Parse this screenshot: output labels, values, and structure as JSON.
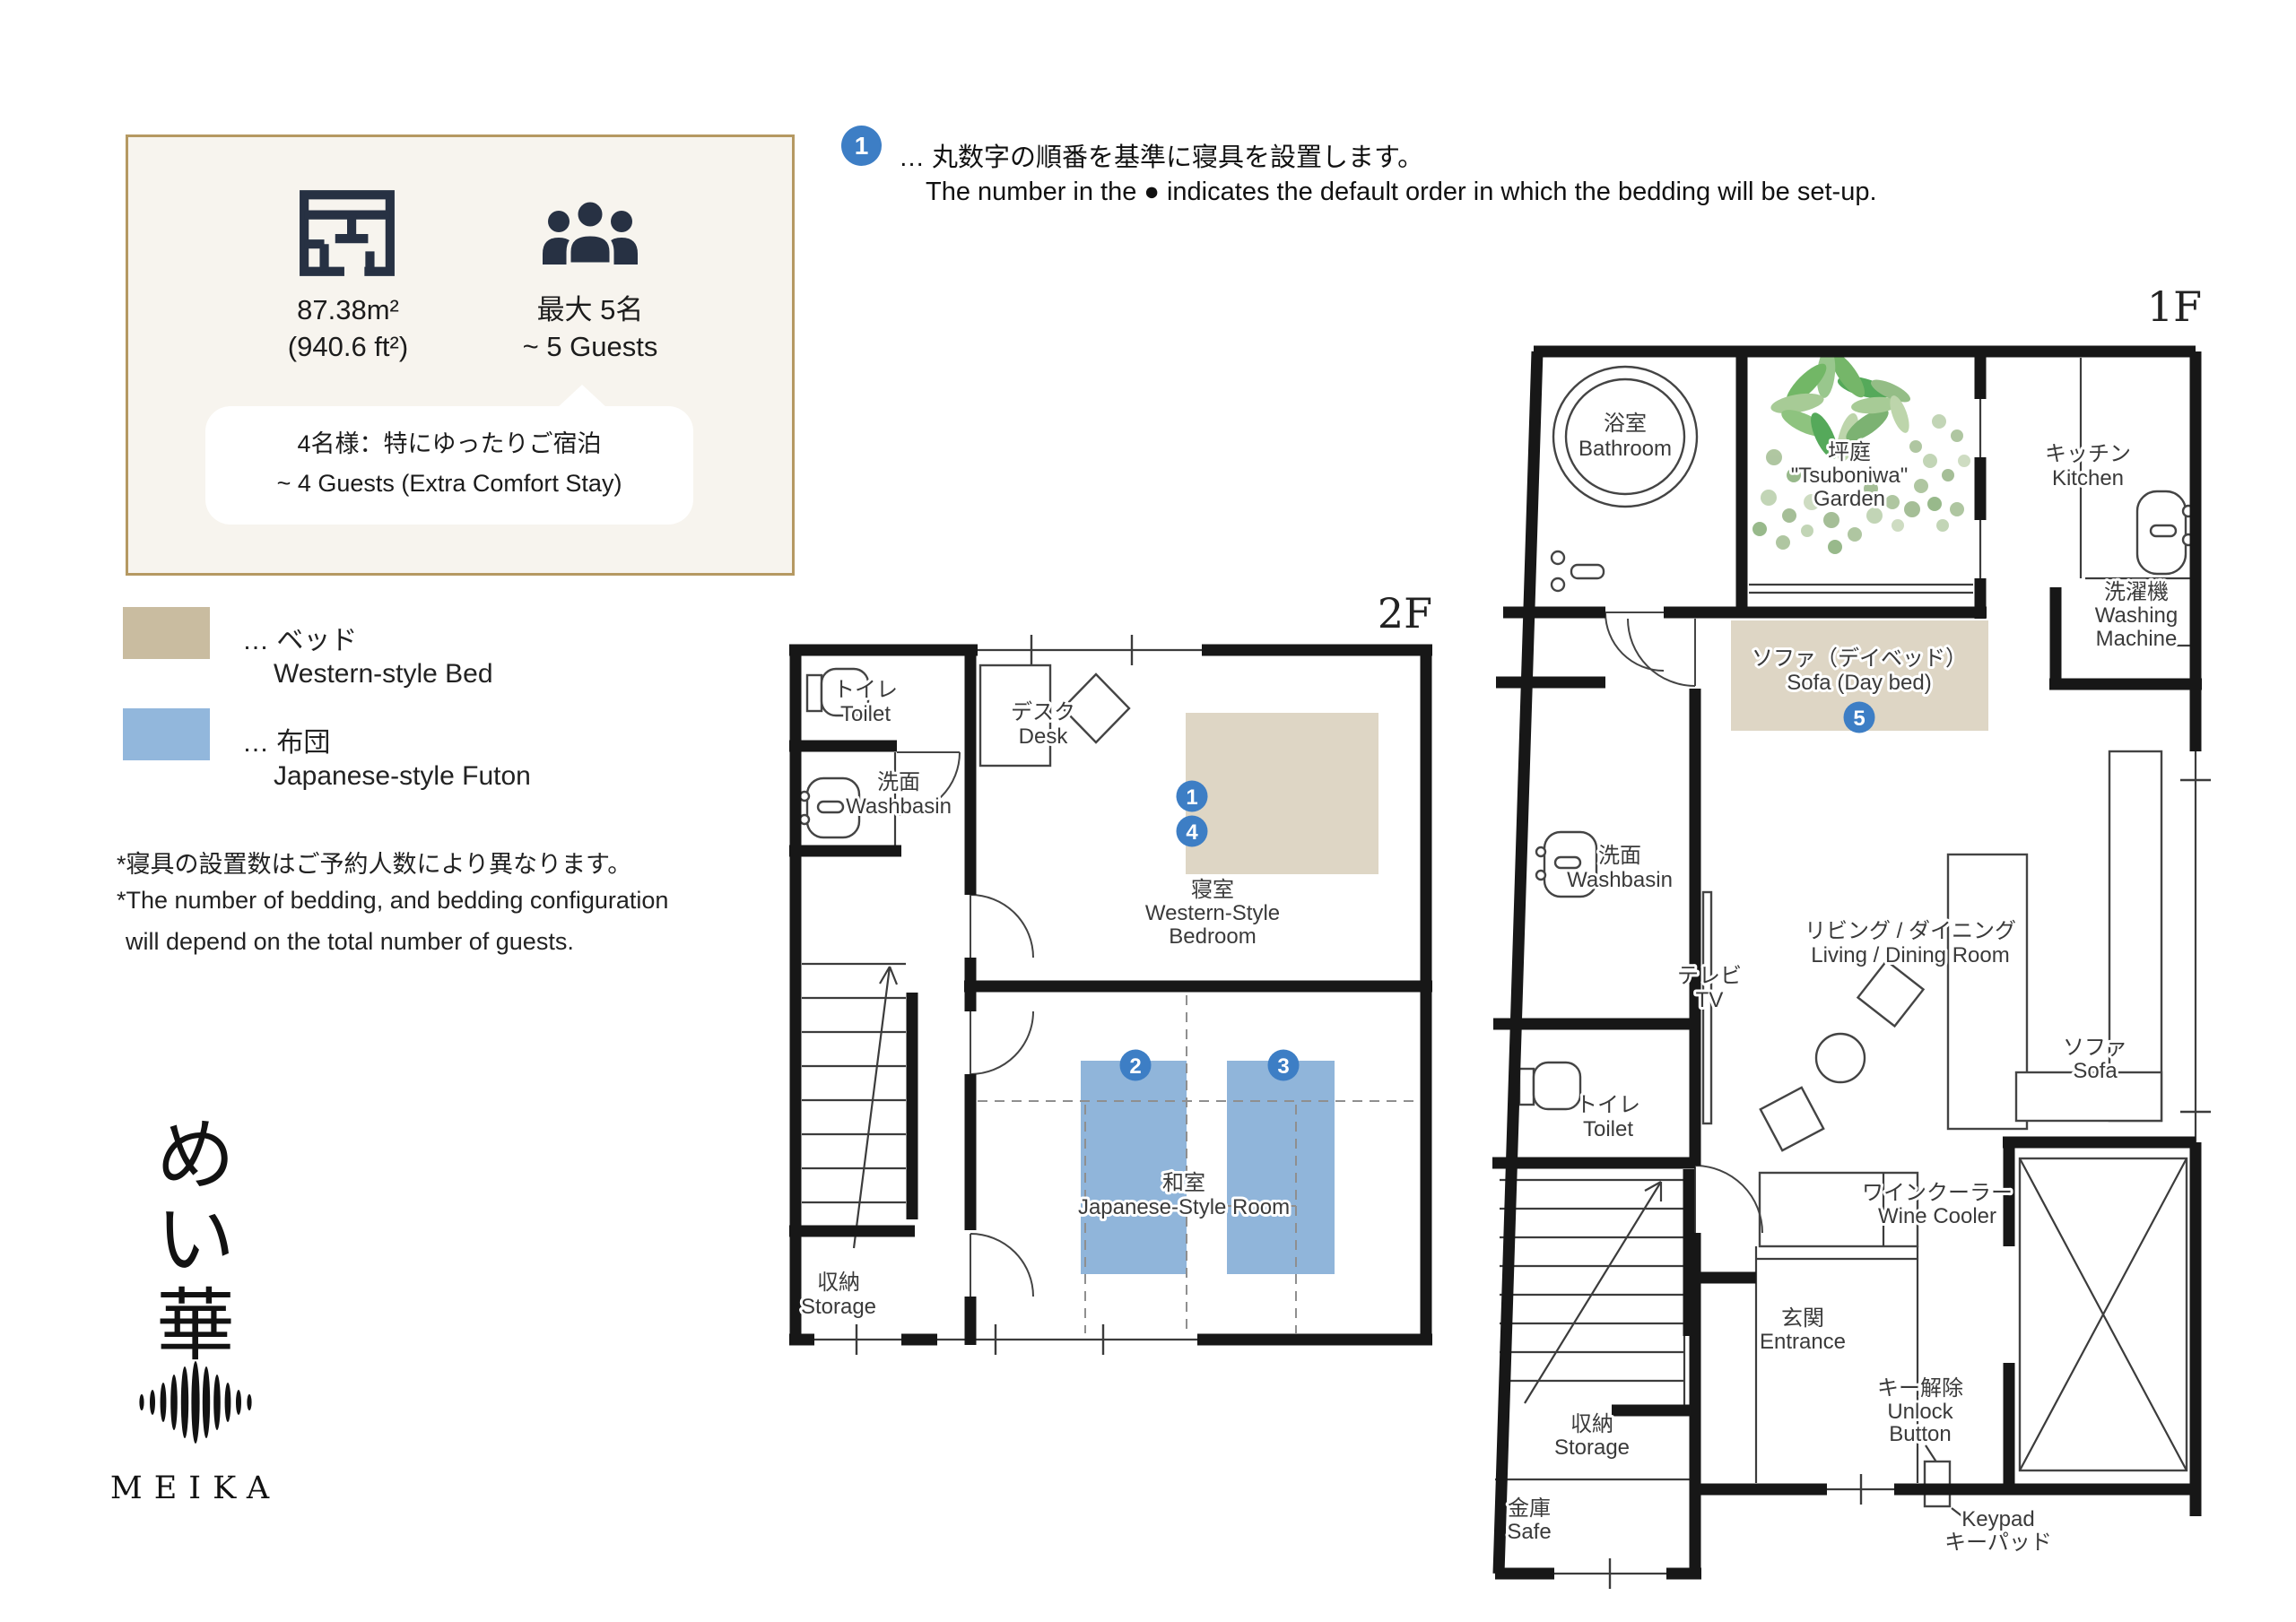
{
  "colors": {
    "card_bg": "#f7f4ee",
    "card_border": "#b59962",
    "icon_navy": "#273143",
    "bed_tan": "#ded6c5",
    "legend_bed_tan": "#c9bca0",
    "futon_blue": "#90b5da",
    "legend_futon_blue": "#92b7dc",
    "badge_blue": "#3d7ec5",
    "wall_black": "#171717",
    "garden_green": "#5aa64f"
  },
  "info_card": {
    "area_value": "87.38m²",
    "area_alt": "(940.6 ft²)",
    "capacity_jp": "最大 5名",
    "capacity_en": "~ 5 Guests",
    "bubble_line_jp": "4名様：特にゆったりご宿泊",
    "bubble_line_en": "~ 4 Guests (Extra Comfort Stay)"
  },
  "bedding_note": {
    "badge_number": "1",
    "line_jp": "… 丸数字の順番を基準に寝具を設置します。",
    "line_en": "The number in the ● indicates the default order in which the bedding will be set-up."
  },
  "legend": {
    "bed_jp": "… ベッド",
    "bed_en": "Western-style Bed",
    "futon_jp": "… 布団",
    "futon_en": "Japanese-style Futon"
  },
  "footnotes": {
    "jp": "*寝具の設置数はご予約人数により異なります。",
    "en1": "*The number of bedding, and bedding configuration",
    "en2": "will depend on the total number of guests."
  },
  "logo": {
    "kana1": "め",
    "kana2": "い",
    "kana3": "華",
    "latin": "MEIKA"
  },
  "floor2": {
    "floor_label": "2F",
    "toilet_jp": "トイレ",
    "toilet_en": "Toilet",
    "washbasin_jp": "洗面",
    "washbasin_en": "Washbasin",
    "desk_jp": "デスク",
    "desk_en": "Desk",
    "bedroom_jp": "寝室",
    "bedroom_en1": "Western-Style",
    "bedroom_en2": "Bedroom",
    "japanese_room_jp": "和室",
    "japanese_room_en": "Japanese-Style Room",
    "storage_jp": "収納",
    "storage_en": "Storage",
    "marker_bed_1": "1",
    "marker_bed_2": "4",
    "marker_futon_1": "2",
    "marker_futon_2": "3"
  },
  "floor1": {
    "floor_label": "1F",
    "bathroom_jp": "浴室",
    "bathroom_en": "Bathroom",
    "garden_jp": "坪庭",
    "garden_en1": "\"Tsuboniwa\"",
    "garden_en2": "Garden",
    "kitchen_jp": "キッチン",
    "kitchen_en": "Kitchen",
    "washing_jp": "洗濯機",
    "washing_en1": "Washing",
    "washing_en2": "Machine",
    "daybed_jp": "ソファ（デイベッド）",
    "daybed_en": "Sofa (Day bed)",
    "marker_daybed": "5",
    "washbasin_jp": "洗面",
    "washbasin_en": "Washbasin",
    "tv_jp": "テレビ",
    "tv_en": "TV",
    "toilet_jp": "トイレ",
    "toilet_en": "Toilet",
    "living_jp": "リビング / ダイニング",
    "living_en": "Living / Dining Room",
    "sofa_jp": "ソファ",
    "sofa_en": "Sofa",
    "wine_jp": "ワインクーラー",
    "wine_en": "Wine Cooler",
    "entrance_jp": "玄関",
    "entrance_en": "Entrance",
    "unlock_jp": "キー解除",
    "unlock_en1": "Unlock",
    "unlock_en2": "Button",
    "storage_jp": "収納",
    "storage_en": "Storage",
    "safe_jp": "金庫",
    "safe_en": "Safe",
    "keypad_en": "Keypad",
    "keypad_jp": "キーパッド"
  }
}
